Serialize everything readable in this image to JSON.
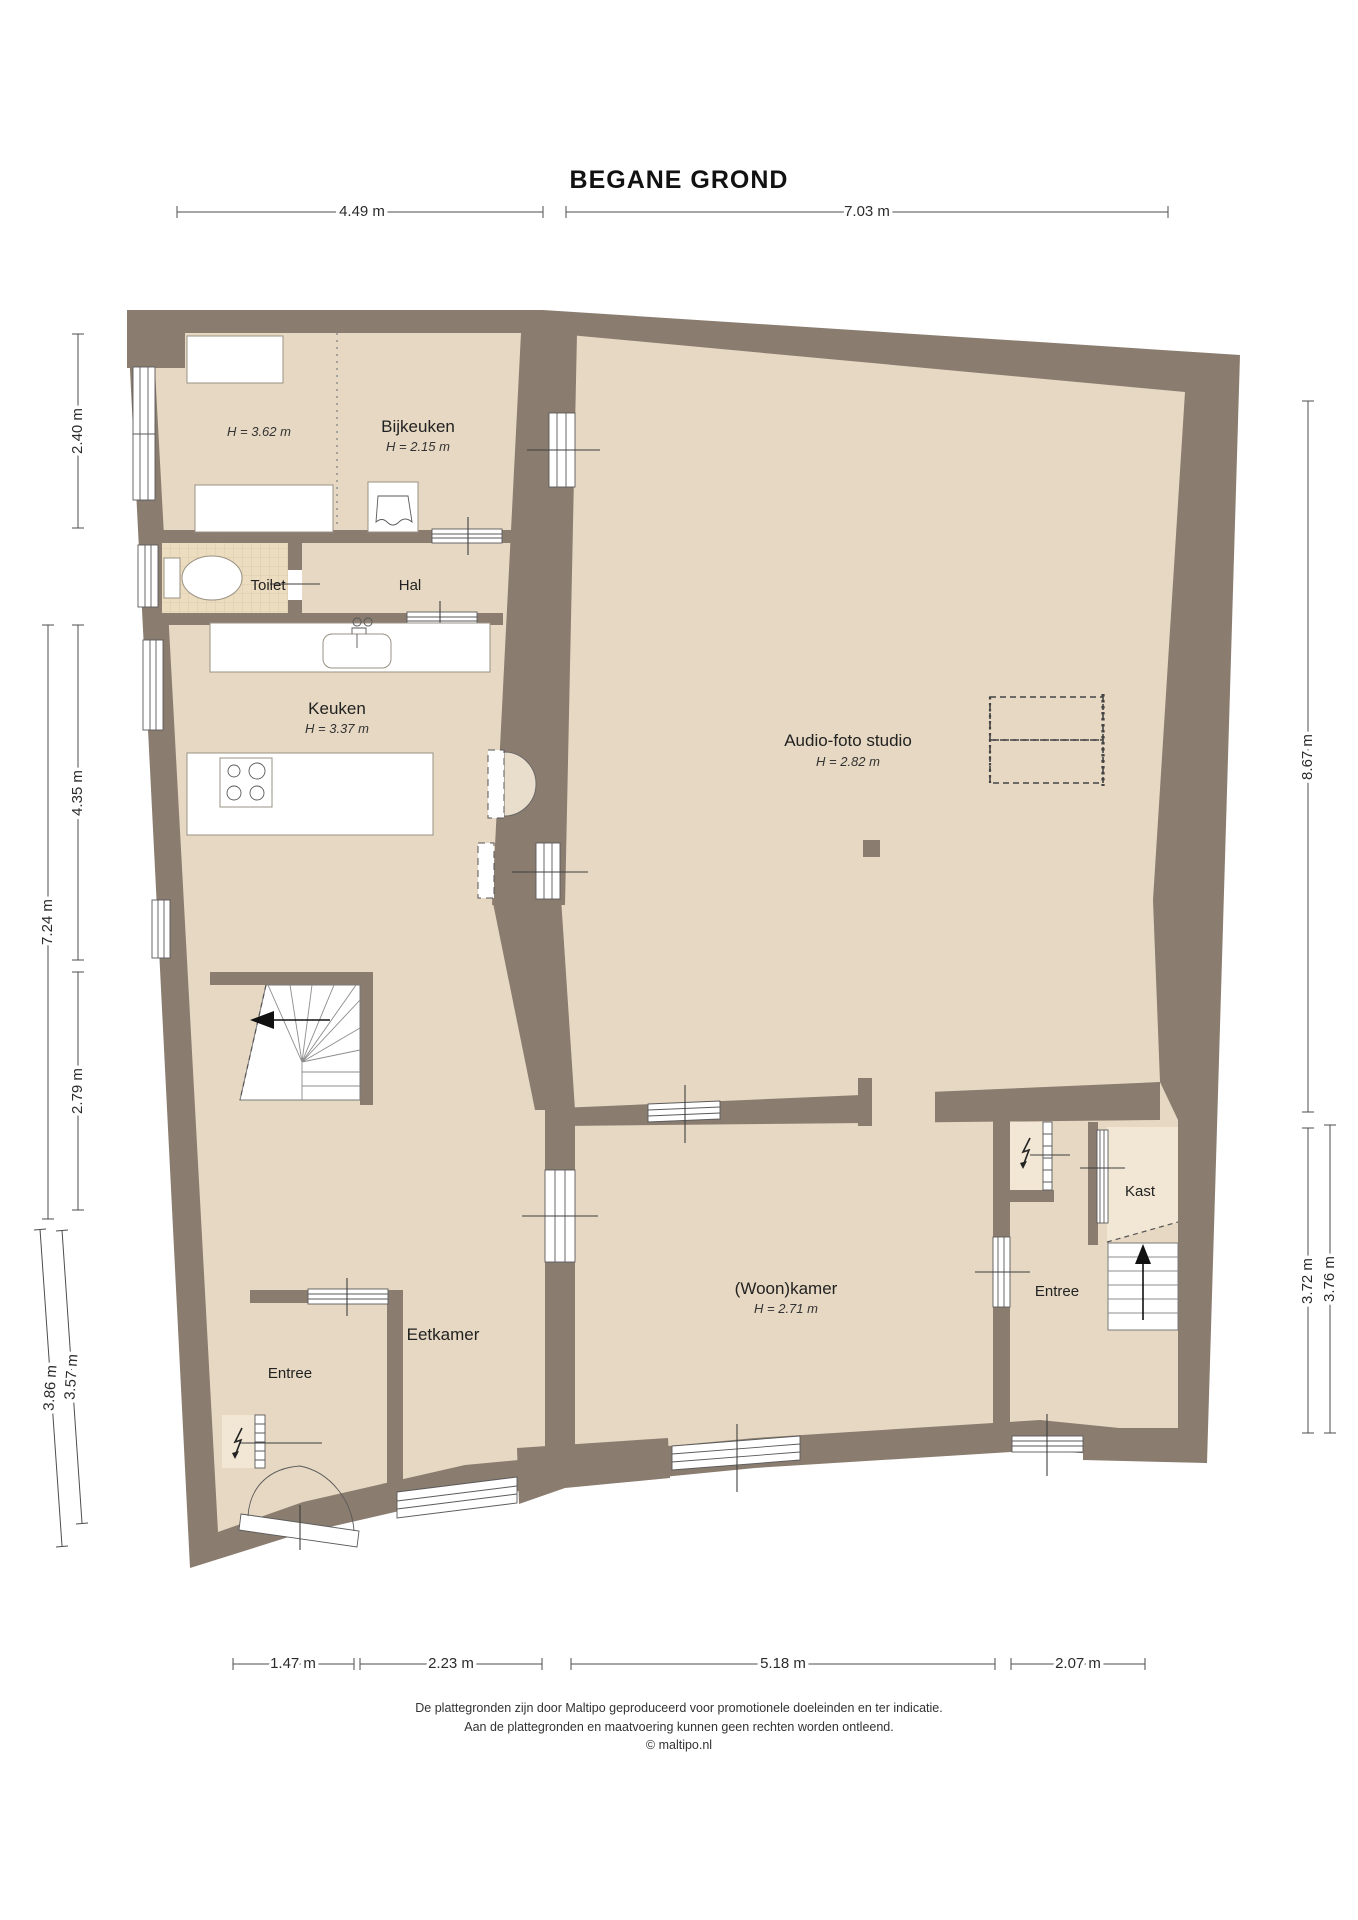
{
  "title": "BEGANE GROND",
  "rooms": {
    "storage": {
      "height": "H = 3.62 m"
    },
    "bijkeuken": {
      "label": "Bijkeuken",
      "height": "H = 2.15 m"
    },
    "toilet": {
      "label": "Toilet"
    },
    "hal": {
      "label": "Hal"
    },
    "keuken": {
      "label": "Keuken",
      "height": "H = 3.37 m"
    },
    "studio": {
      "label": "Audio-foto studio",
      "height": "H = 2.82 m"
    },
    "eetkamer": {
      "label": "Eetkamer"
    },
    "entree_left": {
      "label": "Entree"
    },
    "woonkamer": {
      "label": "(Woon)kamer",
      "height": "H = 2.71 m"
    },
    "entree_right": {
      "label": "Entree"
    },
    "kast": {
      "label": "Kast"
    }
  },
  "dimensions": {
    "top": [
      {
        "label": "4.49 m"
      },
      {
        "label": "7.03 m"
      }
    ],
    "left": [
      {
        "label": "2.40 m"
      },
      {
        "label": "4.35 m"
      },
      {
        "label": "7.24 m"
      },
      {
        "label": "2.79 m"
      },
      {
        "label": "3.86 m"
      },
      {
        "label": "3.57 m"
      }
    ],
    "right": [
      {
        "label": "8.67 m"
      },
      {
        "label": "3.72 m"
      },
      {
        "label": "3.76 m"
      }
    ],
    "bottom": [
      {
        "label": "1.47 m"
      },
      {
        "label": "2.23 m"
      },
      {
        "label": "5.18 m"
      },
      {
        "label": "2.07 m"
      }
    ]
  },
  "footer": {
    "line1": "De plattegronden zijn door Maltipo geproduceerd voor promotionele doeleinden en ter indicatie.",
    "line2": "Aan de plattegronden en maatvoering kunnen geen rechten worden ontleend.",
    "line3": "© maltipo.nl"
  },
  "colors": {
    "wall": "#8a7c6f",
    "floor": "#e6d8c2",
    "toilet_tiles": "#ecdcc0",
    "closet_floor": "#f1e7d4",
    "dimension_line": "#4d4d4d"
  }
}
